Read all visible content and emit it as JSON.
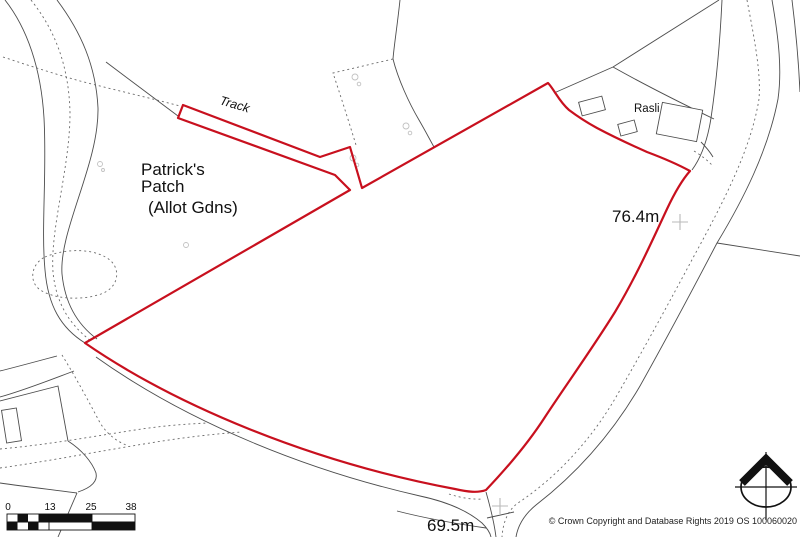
{
  "map": {
    "region_labels": {
      "track": "Track",
      "allotment_line1": "Patrick's",
      "allotment_line2": "Patch",
      "allotment_line3": "(Allot Gdns)",
      "property": "Rasli"
    },
    "elevation_markers": {
      "northeast": "76.4m",
      "south": "69.5m"
    },
    "scale_bar": {
      "ticks": [
        "0",
        "13",
        "25",
        "38"
      ]
    },
    "attribution": "© Crown Copyright and Database Rights 2019 OS 100060020",
    "colors": {
      "boundary_red": "#c8101e",
      "road_gray": "#4d4d4d",
      "faint_gray": "#b9b9b9"
    },
    "icons": {
      "north_indicator": "compass-north-icon"
    }
  }
}
